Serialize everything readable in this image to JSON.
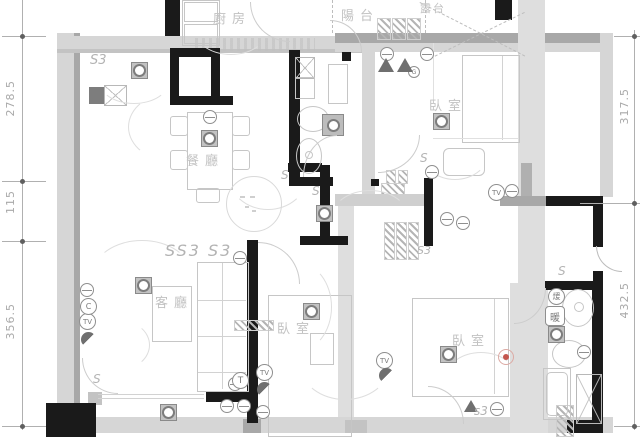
{
  "drawing": {
    "type": "apartment electrical / lighting floor plan",
    "colors": {
      "wall_black": "#1a1a1a",
      "wall_gray_light": "#d6d6d6",
      "wall_gray_dark": "#a8a8a8",
      "line_gray": "#c6c6c6",
      "label_gray": "#c2c2c2",
      "symbol_gray": "#6f6f6f",
      "accent_red": "#c4574f"
    }
  },
  "rooms": {
    "kitchen": "廚房",
    "balcony": "陽台",
    "terrace": "露台",
    "bedroom_top_right": "臥室",
    "dining": "餐廳",
    "living": "客廳",
    "bedroom_middle": "臥室",
    "bedroom_bottom_right": "臥室"
  },
  "dimensions": {
    "left": [
      {
        "label": "278.5"
      },
      {
        "label": "115"
      },
      {
        "label": "356.5"
      }
    ],
    "right": [
      {
        "label": "317.5"
      },
      {
        "label": "432.5"
      }
    ]
  },
  "electrical": {
    "tv": "TV",
    "t": "T",
    "c": "C",
    "g": "G",
    "s": "S",
    "s3": "S3",
    "ss3": "SS3 S3",
    "s3_small": "s3",
    "heater_top": "煖",
    "heater_bottom": "暖"
  }
}
